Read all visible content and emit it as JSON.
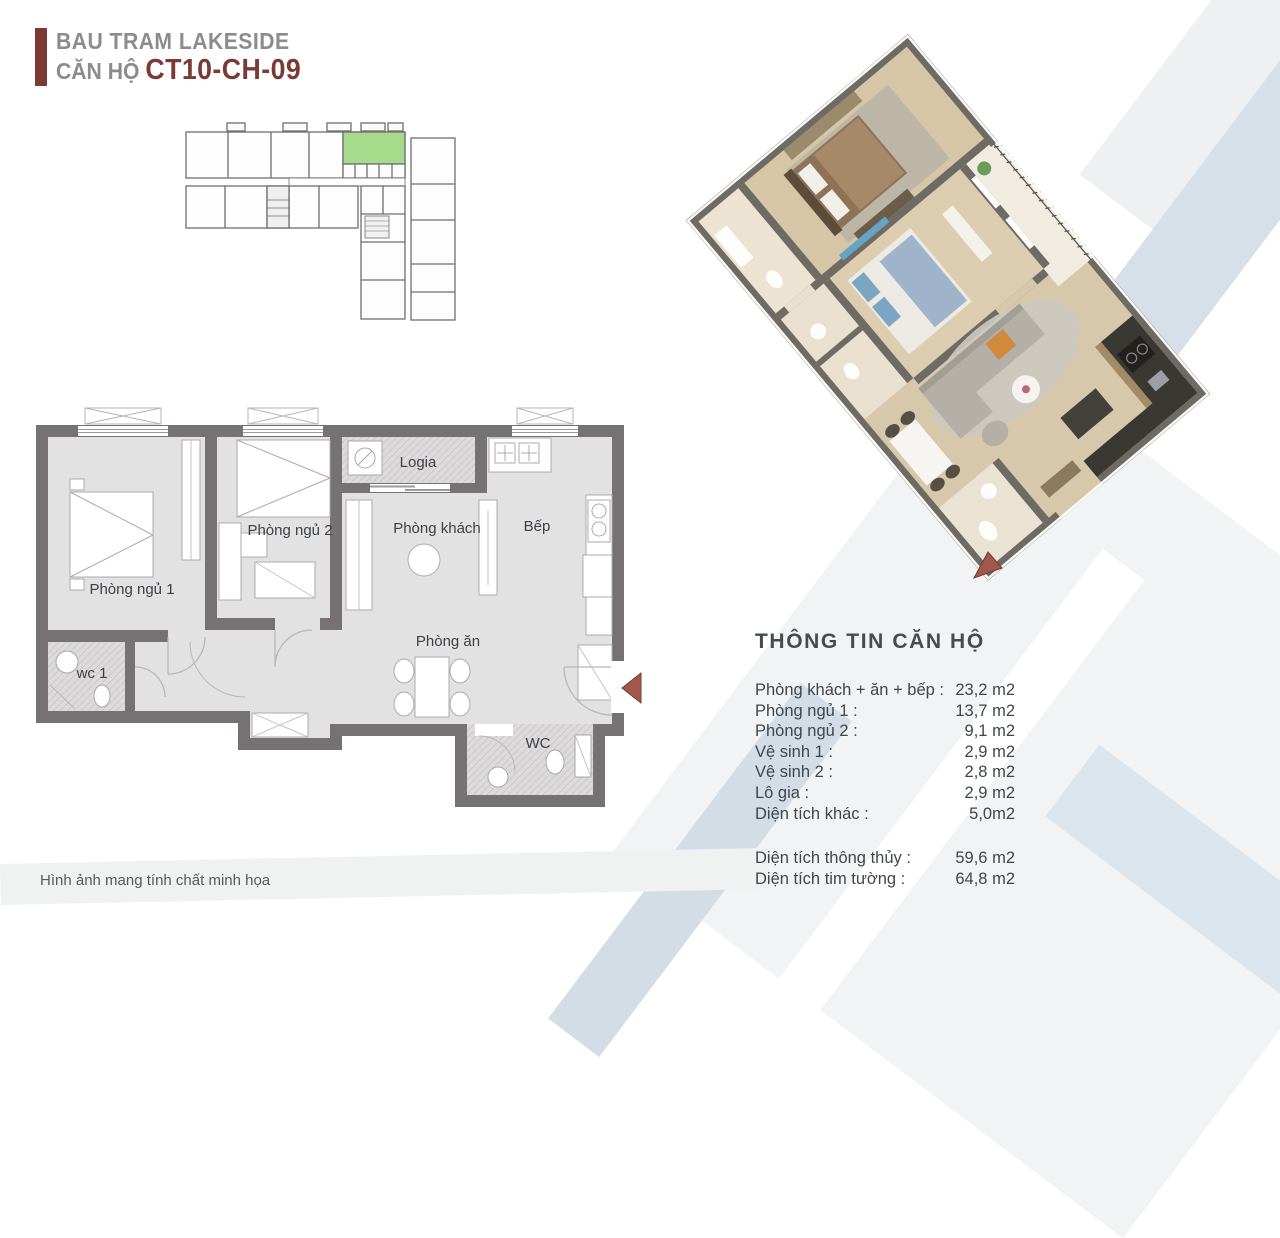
{
  "header": {
    "project": "BAU TRAM LAKESIDE",
    "unit_prefix": "CĂN HỘ ",
    "unit_code": "CT10-CH-09",
    "accent_color": "#7b3a34",
    "text_color": "#8c8c8c"
  },
  "key_plan": {
    "description": "L-shaped floor key plan with highlighted unit",
    "highlight_color": "#a7db8c",
    "outline_color": "#6f6f6f"
  },
  "floor_plan_2d": {
    "wall_color": "#767173",
    "floor_color": "#e3e2e2",
    "entrance_arrow_icon_color": "#a2564c",
    "rooms": [
      {
        "label": "Phòng ngủ 1"
      },
      {
        "label": "Phòng ngủ 2"
      },
      {
        "label": "wc 1"
      },
      {
        "label": "Logia"
      },
      {
        "label": "Phòng khách"
      },
      {
        "label": "Bếp"
      },
      {
        "label": "Phòng ăn"
      },
      {
        "label": "WC"
      }
    ]
  },
  "plan_3d": {
    "description": "isometric 3D render of the same unit",
    "floor_color": "#d8c8ab",
    "wall_color": "#6e6a64",
    "entrance_arrow_icon_color": "#a2564c"
  },
  "info_panel": {
    "title": "THÔNG TIN CĂN HỘ",
    "rows": [
      {
        "label": "Phòng khách + ăn + bếp :",
        "value": "23,2 m2"
      },
      {
        "label": "Phòng ngủ 1 :",
        "value": "13,7 m2"
      },
      {
        "label": "Phòng ngủ 2 :",
        "value": "9,1 m2"
      },
      {
        "label": "Vệ sinh 1 :",
        "value": "2,9 m2"
      },
      {
        "label": "Vệ sinh 2 :",
        "value": "2,8 m2"
      },
      {
        "label": "Lô gia :",
        "value": "2,9 m2"
      },
      {
        "label": "Diện tích khác :",
        "value": "5,0m2"
      }
    ],
    "summary_rows": [
      {
        "label": "Diện tích thông thủy :",
        "value": "59,6 m2"
      },
      {
        "label": "Diện tích tim tường :",
        "value": "64,8 m2"
      }
    ]
  },
  "disclaimer": "Hình ảnh mang tính chất minh họa",
  "background": {
    "band_gray": "#eef0f2",
    "band_blue": "#d7e0e9",
    "panel_gray": "#f2f3f4"
  }
}
